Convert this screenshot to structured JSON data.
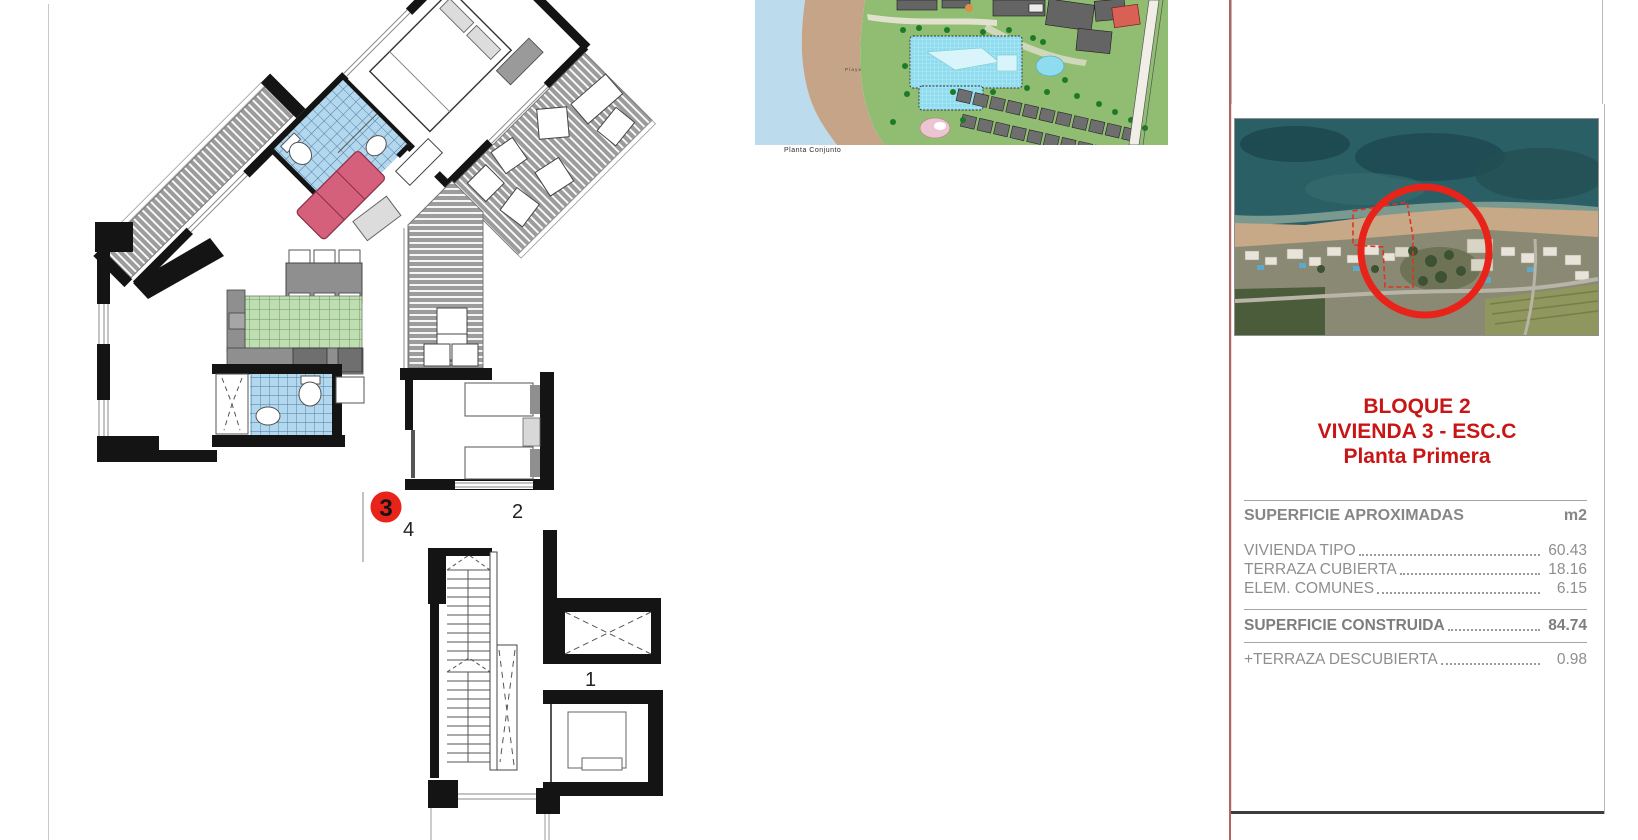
{
  "floor_plan": {
    "marker_number": "3",
    "marker_color": "#e8231a",
    "label_hall": "4",
    "label_room2": "2",
    "label_landing": "1"
  },
  "site_plan": {
    "caption": "Planta Conjunto",
    "beach_label": "Playa"
  },
  "info_panel": {
    "title_line1": "BLOQUE 2",
    "title_line2": "VIVIENDA 3 - ESC.C",
    "title_line3": "Planta Primera",
    "title_color": "#c81616",
    "surfaces_header": "SUPERFICIE APROXIMADAS",
    "surfaces_unit": "m2",
    "rows": [
      {
        "label": "VIVIENDA TIPO",
        "value": "60.43"
      },
      {
        "label": "TERRAZA CUBIERTA",
        "value": "18.16"
      },
      {
        "label": "ELEM. COMUNES",
        "value": "6.15"
      }
    ],
    "total": {
      "label": "SUPERFICIE CONSTRUIDA",
      "value": "84.74"
    },
    "extra": {
      "label": "+TERRAZA DESCUBIERTA",
      "value": "0.98"
    },
    "text_color": "#8e8e8e",
    "divider_color": "#b4645c"
  }
}
